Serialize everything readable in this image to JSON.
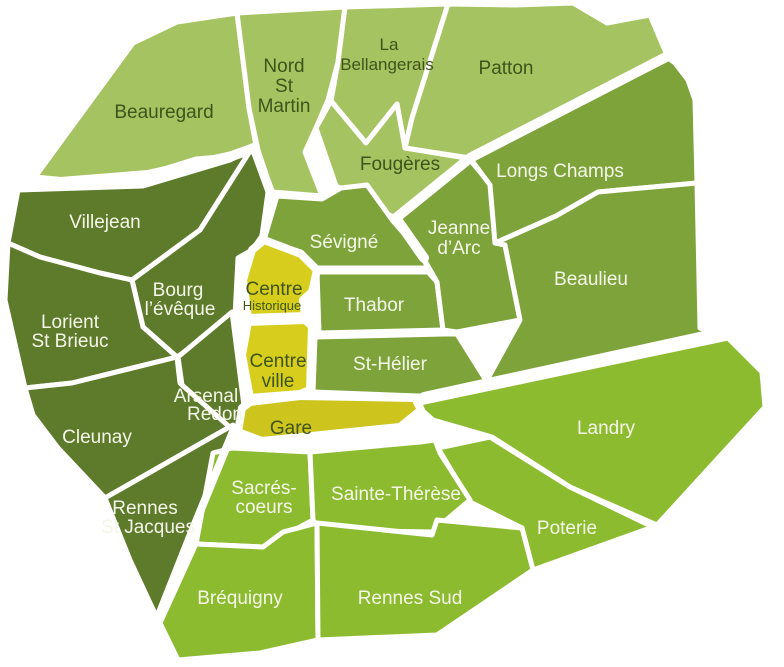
{
  "map": {
    "colors": {
      "light_green": "#a6c361",
      "medium_green": "#7da33a",
      "dark_green": "#5e7a2b",
      "bright_green": "#8dbb30",
      "yellow_centre": "#d7cd1d",
      "yellow_gare": "#cdc41d",
      "boundary_white": "#ffffff",
      "label_on_light": "#3f541a",
      "label_on_dark": "#f4f7e8"
    },
    "districts": [
      {
        "id": "beauregard",
        "group": "light_green",
        "lines": [
          "Beauregard"
        ]
      },
      {
        "id": "nord-st-martin",
        "group": "light_green",
        "lines": [
          "Nord",
          "St",
          "Martin"
        ]
      },
      {
        "id": "la-bellangerais",
        "group": "light_green",
        "lines": [
          "La",
          "Bellangerais"
        ]
      },
      {
        "id": "patton",
        "group": "light_green",
        "lines": [
          "Patton"
        ]
      },
      {
        "id": "fougeres",
        "group": "light_green",
        "lines": [
          "Fougères"
        ]
      },
      {
        "id": "villejean",
        "group": "dark_green",
        "lines": [
          "Villejean"
        ]
      },
      {
        "id": "bourg-leveque",
        "group": "dark_green",
        "lines": [
          "Bourg",
          "l’évêque"
        ]
      },
      {
        "id": "lorient-st-brieuc",
        "group": "dark_green",
        "lines": [
          "Lorient",
          "St Brieuc"
        ]
      },
      {
        "id": "cleunay",
        "group": "dark_green",
        "lines": [
          "Cleunay"
        ]
      },
      {
        "id": "arsenal-redon",
        "group": "dark_green",
        "lines": [
          "Arsenal",
          "Redon"
        ]
      },
      {
        "id": "rennes-st-jacques",
        "group": "dark_green",
        "lines": [
          "Rennes",
          "St Jacques"
        ]
      },
      {
        "id": "sevigne",
        "group": "medium_green",
        "lines": [
          "Sévigné"
        ]
      },
      {
        "id": "thabor",
        "group": "medium_green",
        "lines": [
          "Thabor"
        ]
      },
      {
        "id": "st-helier",
        "group": "medium_green",
        "lines": [
          "St-Hélier"
        ]
      },
      {
        "id": "jeanne-darc",
        "group": "medium_green",
        "lines": [
          "Jeanne",
          "d’Arc"
        ]
      },
      {
        "id": "longs-champs",
        "group": "medium_green",
        "lines": [
          "Longs Champs"
        ]
      },
      {
        "id": "beaulieu",
        "group": "medium_green",
        "lines": [
          "Beaulieu"
        ]
      },
      {
        "id": "centre-historique",
        "group": "yellow_centre",
        "lines": [
          "Centre",
          "Historique"
        ]
      },
      {
        "id": "centre-ville",
        "group": "yellow_centre",
        "lines": [
          "Centre",
          "ville"
        ]
      },
      {
        "id": "gare",
        "group": "yellow_gare",
        "lines": [
          "Gare"
        ]
      },
      {
        "id": "sacres-coeurs",
        "group": "bright_green",
        "lines": [
          "Sacrés-",
          "coeurs"
        ]
      },
      {
        "id": "sainte-therese",
        "group": "bright_green",
        "lines": [
          "Sainte-Thérèse"
        ]
      },
      {
        "id": "brequigny",
        "group": "bright_green",
        "lines": [
          "Bréquigny"
        ]
      },
      {
        "id": "rennes-sud",
        "group": "bright_green",
        "lines": [
          "Rennes Sud"
        ]
      },
      {
        "id": "landry",
        "group": "bright_green",
        "lines": [
          "Landry"
        ]
      },
      {
        "id": "poterie",
        "group": "bright_green",
        "lines": [
          "Poterie"
        ]
      }
    ]
  }
}
